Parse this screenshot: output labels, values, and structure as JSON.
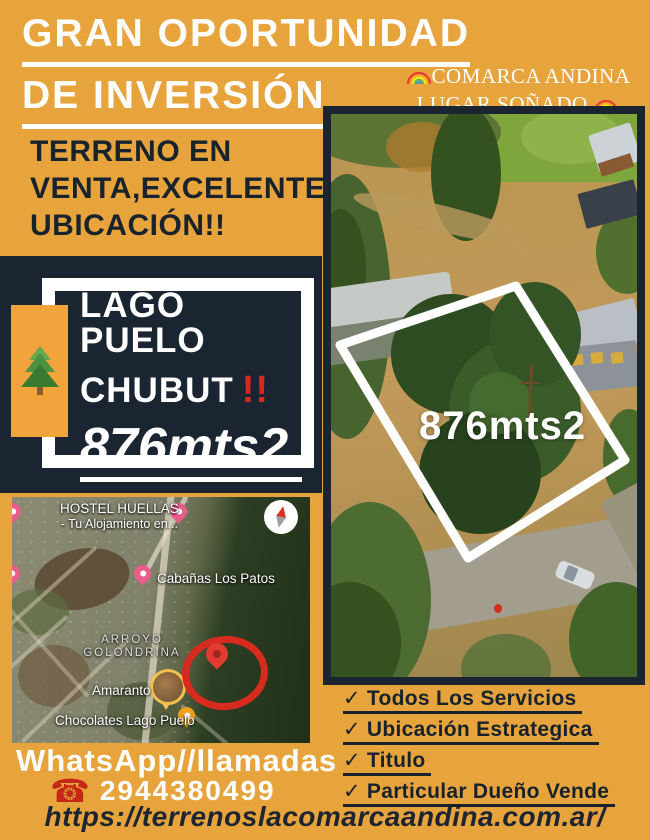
{
  "colors": {
    "background": "#E7A43C",
    "navy": "#1B2531",
    "text_dark": "#19232E",
    "accent_red": "#D7281D",
    "white": "#FFFFFF"
  },
  "header": {
    "title_line1": "GRAN OPORTUNIDAD",
    "title_line2": "DE INVERSIÓN",
    "brand_line1": "COMARCA ANDINA",
    "brand_line2": "LUGAR SOÑADO",
    "brand_icon": "rainbow-icon"
  },
  "intro": {
    "line1": "TERRENO EN",
    "line2": "VENTA,EXCELENTE",
    "line3": "UBICACIÓN!!"
  },
  "card": {
    "line1": "LAGO PUELO",
    "line2": "CHUBUT",
    "bang": "!!",
    "area": "876mts2",
    "tree_icon": "evergreen-tree-icon"
  },
  "photo": {
    "area_label": "876mts2",
    "plot_outline": "white-boundary"
  },
  "map": {
    "hostel_name": "HOSTEL HUELLAS",
    "hostel_sub": "- Tu Alojamiento en...",
    "cabanas": "Cabañas Los Patos",
    "arroyo_line1": "ARROYO",
    "arroyo_line2": "GOLONDRINA",
    "amaranto": "Amaranto",
    "chocolates": "Chocolates Lago Puelo",
    "compass_icon": "compass-icon"
  },
  "features": [
    {
      "check": "✓",
      "label": "Todos Los Servicios"
    },
    {
      "check": "✓",
      "label": "Ubicación Estrategica"
    },
    {
      "check": "✓",
      "label": "Titulo"
    },
    {
      "check": "✓",
      "label": "Particular Dueño Vende"
    }
  ],
  "contact": {
    "whatsapp": "WhatsApp//llamadas",
    "phone_icon": "☎",
    "phone": "2944380499",
    "url": "https://terrenoslacomarcaandina.com.ar/"
  }
}
